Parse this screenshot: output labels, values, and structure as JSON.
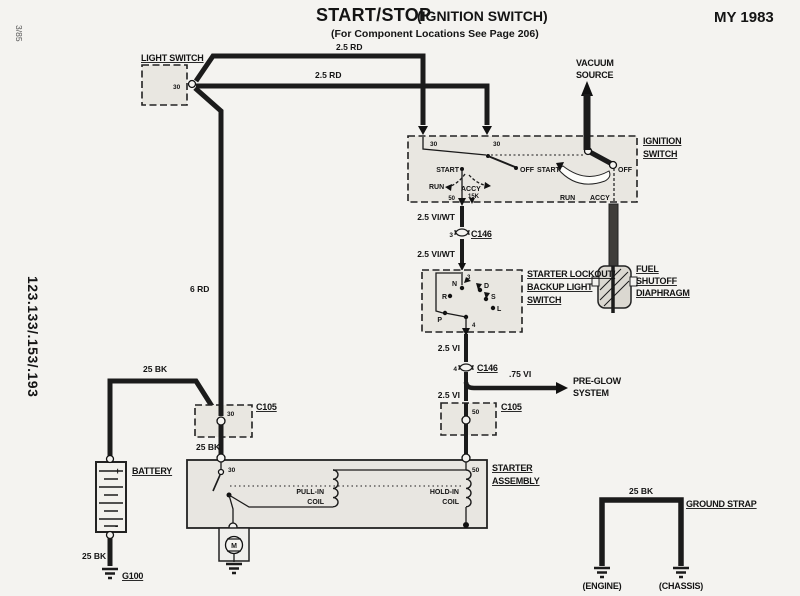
{
  "header": {
    "edition": "3/85",
    "models": "123.133/.153/.193",
    "title_main": "START/STOP",
    "title_sub": "(IGNITION SWITCH)",
    "locations_note": "(For Component Locations See Page 206)",
    "model_year": "MY 1983"
  },
  "components": {
    "light_switch": {
      "label": "LIGHT SWITCH",
      "terminal_30": "30"
    },
    "ignition_switch": {
      "label1": "IGNITION",
      "label2": "SWITCH",
      "terminal_30a": "30",
      "terminal_30b": "30",
      "terminal_50": "50",
      "terminal_15k": "15K",
      "pos_start": "START",
      "pos_run": "RUN",
      "pos_accy": "ACCY",
      "pos_off": "OFF",
      "mech_start": "START",
      "mech_run": "RUN",
      "mech_accy": "ACCY",
      "mech_off": "OFF"
    },
    "vacuum_source": {
      "label1": "VACUUM",
      "label2": "SOURCE"
    },
    "fuel_shutoff": {
      "label1": "FUEL",
      "label2": "SHUTOFF",
      "label3": "DIAPHRAGM"
    },
    "lockout_switch": {
      "label1": "STARTER LOCKOUT/",
      "label2": "BACKUP LIGHT",
      "label3": "SWITCH",
      "terminal_top": "3",
      "terminal_bottom": "4",
      "pos_p": "P",
      "pos_r": "R",
      "pos_n": "N",
      "pos_d": "D",
      "pos_s": "S",
      "pos_l": "L"
    },
    "preglow": {
      "label1": "PRE-GLOW",
      "label2": "SYSTEM"
    },
    "starter": {
      "label1": "STARTER",
      "label2": "ASSEMBLY",
      "terminal_30": "30",
      "terminal_50": "50",
      "pullin1": "PULL-IN",
      "pullin2": "COIL",
      "holdin1": "HOLD-IN",
      "holdin2": "COIL",
      "motor": "M"
    },
    "battery": {
      "label": "BATTERY",
      "plus": "+",
      "minus": "-"
    },
    "grounds": {
      "g100": "G100",
      "engine": "(ENGINE)",
      "chassis": "(CHASSIS)",
      "ground_strap": "GROUND STRAP"
    }
  },
  "connectors": {
    "c146_upper": {
      "pin": "3",
      "name": "C146"
    },
    "c146_lower": {
      "pin": "4",
      "name": "C146"
    },
    "c105_left": {
      "pin": "30",
      "name": "C105"
    },
    "c105_right": {
      "pin": "50",
      "name": "C105"
    }
  },
  "wires": {
    "rd_top": "2.5 RD",
    "rd_mid": "2.5 RD",
    "rd_vert": "6 RD",
    "viwt_upper": "2.5 VI/WT",
    "viwt_lower": "2.5 VI/WT",
    "vi_upper": "2.5 VI",
    "vi_preglow": ".75 VI",
    "vi_lower": "2.5 VI",
    "bk_batt_feed": "25 BK",
    "bk_starter_feed": "25 BK",
    "bk_batt_ground": "25 BK",
    "bk_ground_strap": "25 BK"
  }
}
